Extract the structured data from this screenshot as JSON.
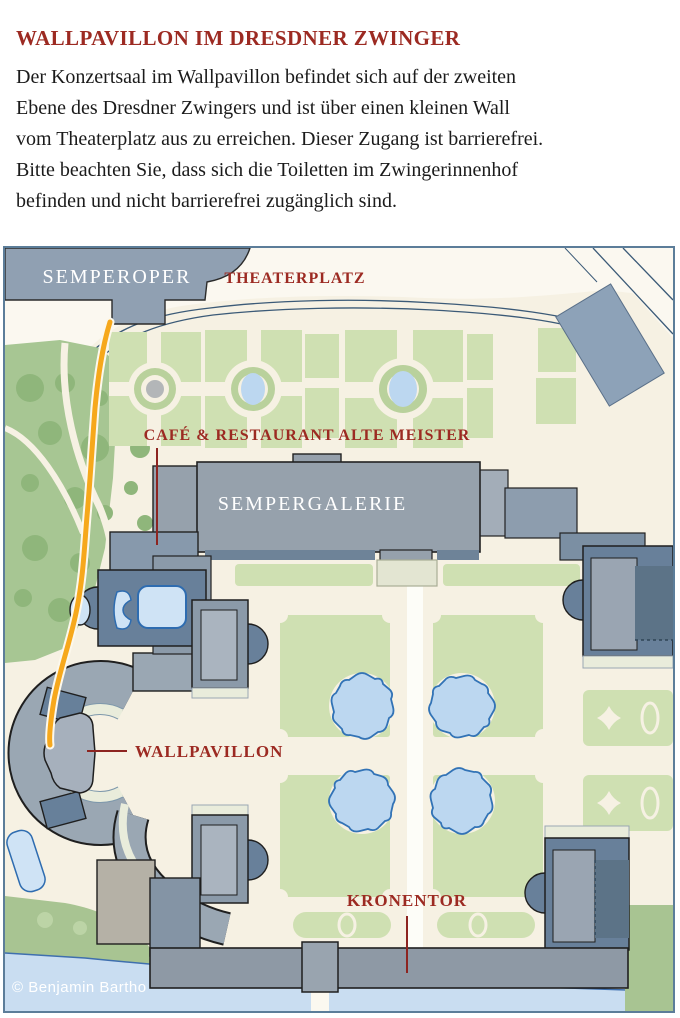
{
  "page": {
    "title": "WALLPAVILLON IM DRESDNER ZWINGER",
    "body_lines": [
      "Der Konzertsaal im Wallpavillon befindet sich auf der zweiten",
      "Ebene des Dresdner Zwingers und ist über einen kleinen Wall",
      "vom Theaterplatz aus zu erreichen. Dieser Zugang ist barrierefrei.",
      "Bitte beachten Sie, dass sich die Toiletten im Zwingerinnenhof",
      "befinden und nicht barrierefrei zugänglich sind."
    ]
  },
  "map": {
    "labels": {
      "semperoper": "SEMPEROPER",
      "theaterplatz": "THEATERPLATZ",
      "cafe": "CAFÉ & RESTAURANT ALTE MEISTER",
      "sempergalerie": "SEMPERGALERIE",
      "wallpavillon": "WALLPAVILLON",
      "kronentor": "KRONENTOR"
    },
    "credit": "© Benjamin Bartho",
    "colors": {
      "title_red": "#9c2a22",
      "label_red": "#9c2a22",
      "route_yellow": "#f6a81c",
      "water_blue": "#c9ddf1",
      "pond_blue": "#bcd7f0",
      "pond_outline": "#3273b6",
      "building_gray": "#96a1ac",
      "building_blue_gray": "#68809a",
      "park_green": "#a7c693",
      "parterre_green": "#cfe0b2",
      "map_cream": "#f6f1e3",
      "map_border": "#5c7d99"
    }
  }
}
